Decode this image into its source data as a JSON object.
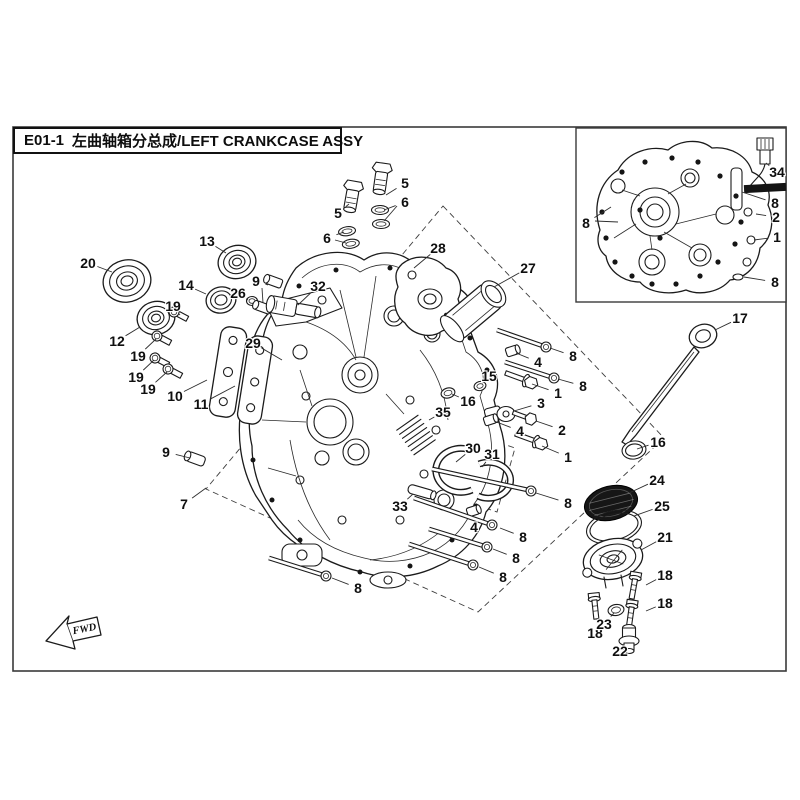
{
  "colors": {
    "background": "#ffffff",
    "line": "#1b1b1b",
    "screen_fill": "#161616"
  },
  "title": {
    "code": "E01-1",
    "text": "左曲轴箱分总成/LEFT CRANKCASE ASSY"
  },
  "fwd_marker": {
    "label": "FWD"
  },
  "callouts": {
    "main": [
      {
        "n": "20",
        "x": 88,
        "y": 263,
        "lx": 112,
        "ly": 272
      },
      {
        "n": "13",
        "x": 207,
        "y": 241,
        "lx": 226,
        "ly": 253
      },
      {
        "n": "14",
        "x": 186,
        "y": 285,
        "lx": 206,
        "ly": 294
      },
      {
        "n": "26",
        "x": 238,
        "y": 293,
        "lx": 248,
        "ly": 300
      },
      {
        "n": "9",
        "x": 256,
        "y": 281,
        "lx": 268,
        "ly": 285
      },
      {
        "n": "12",
        "x": 117,
        "y": 341,
        "lx": 140,
        "ly": 327
      },
      {
        "n": "19",
        "x": 173,
        "y": 306,
        "lx": 180,
        "ly": 315
      },
      {
        "n": "19",
        "x": 138,
        "y": 356,
        "lx": 156,
        "ly": 339
      },
      {
        "n": "19",
        "x": 136,
        "y": 377,
        "lx": 154,
        "ly": 360
      },
      {
        "n": "19",
        "x": 148,
        "y": 389,
        "lx": 167,
        "ly": 372
      },
      {
        "n": "10",
        "x": 175,
        "y": 396,
        "lx": 207,
        "ly": 380
      },
      {
        "n": "11",
        "x": 201,
        "y": 404,
        "lx": 235,
        "ly": 386
      },
      {
        "n": "29",
        "x": 253,
        "y": 343,
        "lx": 282,
        "ly": 360
      },
      {
        "n": "32",
        "x": 318,
        "y": 286,
        "lx": 298,
        "ly": 305
      },
      {
        "n": "5",
        "x": 405,
        "y": 183,
        "lx": 386,
        "ly": 195
      },
      {
        "n": "6",
        "x": 405,
        "y": 202,
        "lx": 384,
        "ly": 210
      },
      {
        "n": "5",
        "x": 338,
        "y": 213,
        "lx": 349,
        "ly": 204
      },
      {
        "n": "6",
        "x": 327,
        "y": 238,
        "lx": 344,
        "ly": 232
      },
      {
        "n": "28",
        "x": 438,
        "y": 248,
        "lx": 414,
        "ly": 268
      },
      {
        "n": "27",
        "x": 528,
        "y": 268,
        "lx": 494,
        "ly": 287
      },
      {
        "n": "17",
        "x": 740,
        "y": 318,
        "lx": 715,
        "ly": 330
      },
      {
        "n": "16",
        "x": 658,
        "y": 442,
        "lx": 637,
        "ly": 449
      },
      {
        "n": "24",
        "x": 657,
        "y": 480,
        "lx": 629,
        "ly": 493
      },
      {
        "n": "25",
        "x": 662,
        "y": 506,
        "lx": 634,
        "ly": 516
      },
      {
        "n": "21",
        "x": 665,
        "y": 537,
        "lx": 641,
        "ly": 550
      },
      {
        "n": "18",
        "x": 665,
        "y": 575,
        "lx": 646,
        "ly": 585
      },
      {
        "n": "18",
        "x": 665,
        "y": 603,
        "lx": 646,
        "ly": 611
      },
      {
        "n": "18",
        "x": 595,
        "y": 633,
        "lx": 597,
        "ly": 620
      },
      {
        "n": "23",
        "x": 604,
        "y": 624,
        "lx": 614,
        "ly": 613
      },
      {
        "n": "22",
        "x": 620,
        "y": 651,
        "lx": 627,
        "ly": 644
      },
      {
        "n": "15",
        "x": 489,
        "y": 376,
        "lx": 482,
        "ly": 384
      },
      {
        "n": "16",
        "x": 468,
        "y": 401,
        "lx": 452,
        "ly": 394
      },
      {
        "n": "35",
        "x": 443,
        "y": 412,
        "lx": 429,
        "ly": 420
      },
      {
        "n": "3",
        "x": 541,
        "y": 403,
        "lx": 514,
        "ly": 411
      },
      {
        "n": "2",
        "x": 562,
        "y": 430,
        "lx": 536,
        "ly": 421
      },
      {
        "n": "4",
        "x": 538,
        "y": 362,
        "lx": 516,
        "ly": 353
      },
      {
        "n": "1",
        "x": 558,
        "y": 393,
        "lx": 532,
        "ly": 384
      },
      {
        "n": "4",
        "x": 520,
        "y": 431,
        "lx": 494,
        "ly": 421
      },
      {
        "n": "1",
        "x": 568,
        "y": 457,
        "lx": 542,
        "ly": 446
      },
      {
        "n": "8",
        "x": 573,
        "y": 356,
        "lx": 550,
        "ly": 348
      },
      {
        "n": "8",
        "x": 583,
        "y": 386,
        "lx": 558,
        "ly": 379
      },
      {
        "n": "8",
        "x": 568,
        "y": 503,
        "lx": 536,
        "ly": 493
      },
      {
        "n": "4",
        "x": 474,
        "y": 527,
        "lx": 473,
        "ly": 515
      },
      {
        "n": "8",
        "x": 523,
        "y": 537,
        "lx": 500,
        "ly": 528
      },
      {
        "n": "8",
        "x": 516,
        "y": 558,
        "lx": 493,
        "ly": 549
      },
      {
        "n": "8",
        "x": 503,
        "y": 577,
        "lx": 479,
        "ly": 567
      },
      {
        "n": "8",
        "x": 358,
        "y": 588,
        "lx": 332,
        "ly": 578
      },
      {
        "n": "33",
        "x": 400,
        "y": 506,
        "lx": 413,
        "ly": 494
      },
      {
        "n": "30",
        "x": 473,
        "y": 448,
        "lx": 456,
        "ly": 462
      },
      {
        "n": "31",
        "x": 492,
        "y": 454,
        "lx": 482,
        "ly": 467
      },
      {
        "n": "9",
        "x": 166,
        "y": 452,
        "lx": 190,
        "ly": 458
      },
      {
        "n": "7",
        "x": 184,
        "y": 504,
        "lx": 206,
        "ly": 488
      }
    ],
    "inset": [
      {
        "n": "34",
        "x": 777,
        "y": 172,
        "lx": 766,
        "ly": 163
      },
      {
        "n": "8",
        "x": 775,
        "y": 203,
        "lx": 742,
        "ly": 192
      },
      {
        "n": "2",
        "x": 776,
        "y": 217,
        "lx": 756,
        "ly": 214
      },
      {
        "n": "1",
        "x": 777,
        "y": 237,
        "lx": 754,
        "ly": 240
      },
      {
        "n": "8",
        "x": 775,
        "y": 282,
        "lx": 744,
        "ly": 277
      },
      {
        "n": "8",
        "x": 586,
        "y": 223,
        "lx": 611,
        "ly": 207
      }
    ],
    "extra_leader_lines": [
      {
        "x1": 595,
        "y1": 221,
        "x2": 618,
        "y2": 222
      },
      {
        "x1": 397,
        "y1": 206,
        "x2": 384,
        "y2": 221
      },
      {
        "x1": 335,
        "y1": 240,
        "x2": 346,
        "y2": 243
      },
      {
        "x1": 262,
        "y1": 288,
        "x2": 263,
        "y2": 303
      }
    ]
  }
}
